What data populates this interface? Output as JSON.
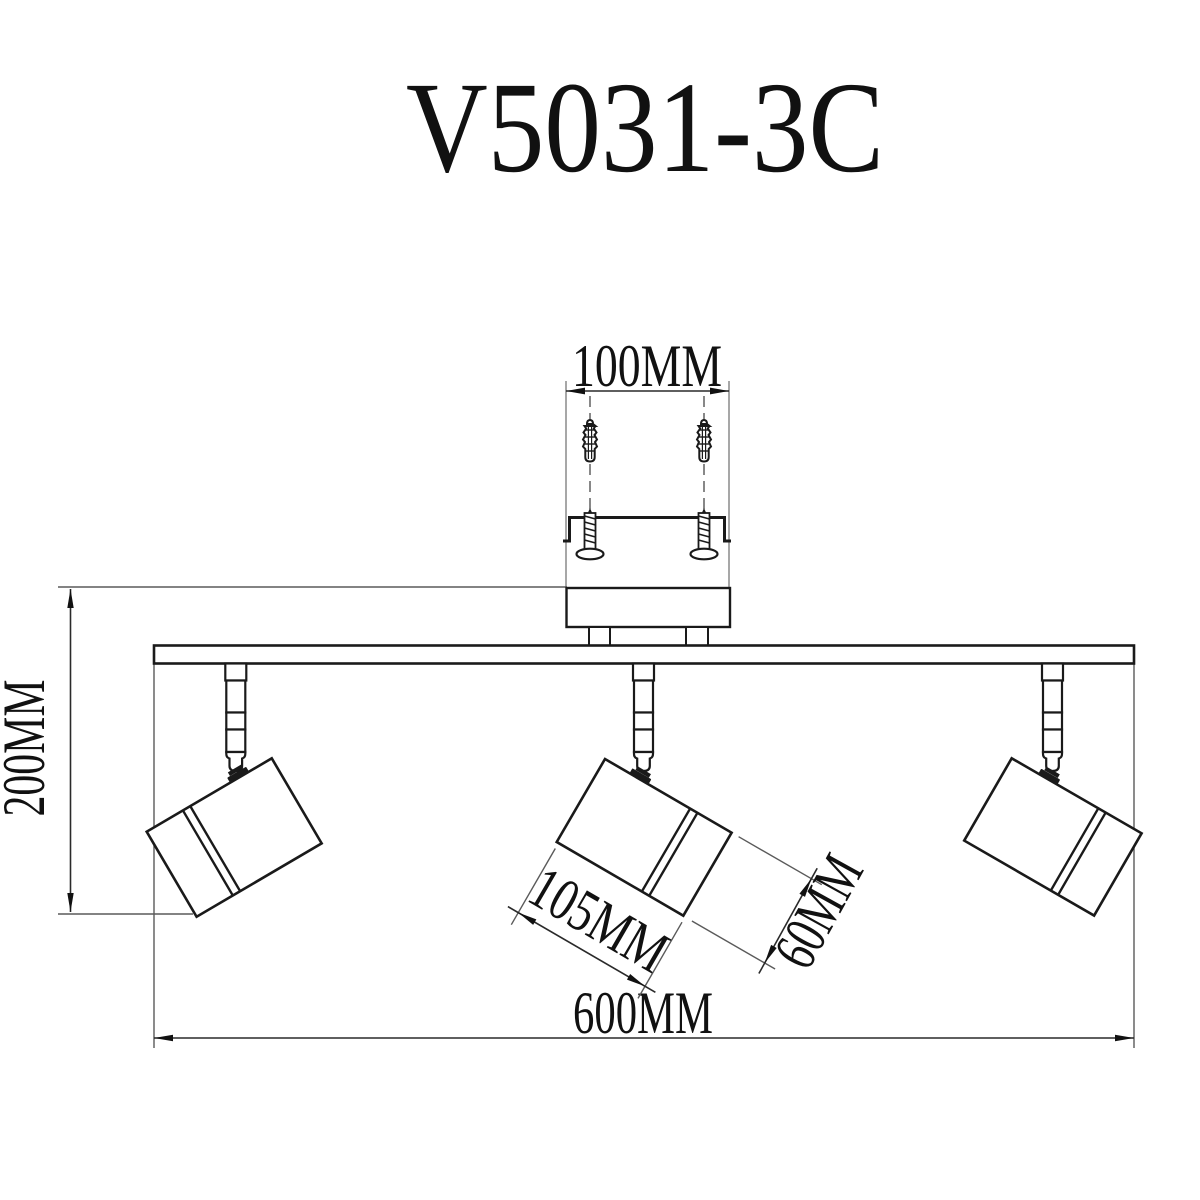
{
  "title": "V5031-3C",
  "labels": {
    "hole_spacing": "100MM",
    "drop_height": "200MM",
    "head_length": "105MM",
    "head_width": "60MM",
    "bar_length": "600MM"
  },
  "colors": {
    "line": "#1a1a1a",
    "dimension": "#2a2a2a",
    "extension": "#8a8a8a",
    "background": "#ffffff"
  }
}
